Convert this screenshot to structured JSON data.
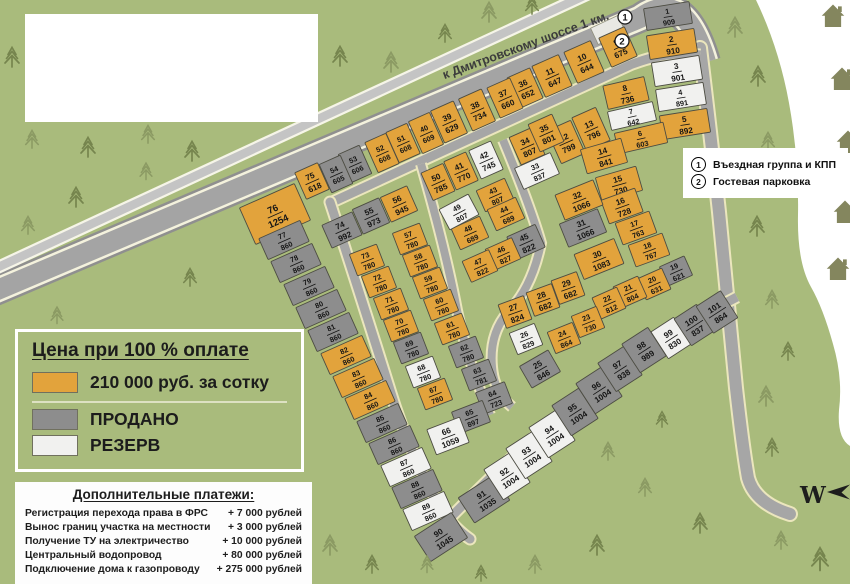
{
  "map": {
    "road_label": "к Дмитровскому шоссе 1 км.",
    "compass_letter": "W",
    "markers": [
      {
        "symbol": "1",
        "label": "Въездная группа и КПП"
      },
      {
        "symbol": "2",
        "label": "Гостевая парковка"
      }
    ]
  },
  "price_legend": {
    "title": "Цена при 100 % оплате",
    "available_label": "210 000 руб. за сотку",
    "sold_label": "ПРОДАНО",
    "reserve_label": "РЕЗЕРВ"
  },
  "extra_payments": {
    "title": "Дополнительные платежи:",
    "items": [
      {
        "label": "Регистрация перехода права в ФРС",
        "value": "+ 7 000 рублей"
      },
      {
        "label": "Вынос границ участка на местности",
        "value": "+ 3 000 рублей"
      },
      {
        "label": "Получение ТУ на электричество",
        "value": "+ 10 000 рублей"
      },
      {
        "label": "Центральный водопровод",
        "value": "+ 80 000 рублей"
      },
      {
        "label": "Подключение дома к газопроводу",
        "value": "+ 275 000 рублей"
      }
    ]
  },
  "colors": {
    "available": "#e2a33c",
    "sold": "#8d8d8d",
    "reserve": "#f1f1ef",
    "plot_stroke": "#4c4c42",
    "green": "#a9bb7c"
  },
  "plots": [
    {
      "n": 1,
      "area": 909,
      "status": "sold"
    },
    {
      "n": 2,
      "area": 910,
      "status": "available"
    },
    {
      "n": 3,
      "area": 901,
      "status": "reserve"
    },
    {
      "n": 4,
      "area": 891,
      "status": "reserve"
    },
    {
      "n": 5,
      "area": 892,
      "status": "available"
    },
    {
      "n": 6,
      "area": 603,
      "status": "available"
    },
    {
      "n": 7,
      "area": 642,
      "status": "reserve"
    },
    {
      "n": 8,
      "area": 736,
      "status": "available"
    },
    {
      "n": 9,
      "area": 675,
      "status": "available"
    },
    {
      "n": 10,
      "area": 644,
      "status": "available"
    },
    {
      "n": 11,
      "area": 647,
      "status": "available"
    },
    {
      "n": 12,
      "area": 799,
      "status": "available"
    },
    {
      "n": 13,
      "area": 796,
      "status": "available"
    },
    {
      "n": 14,
      "area": 841,
      "status": "available"
    },
    {
      "n": 15,
      "area": 730,
      "status": "available"
    },
    {
      "n": 16,
      "area": 728,
      "status": "available"
    },
    {
      "n": 17,
      "area": 763,
      "status": "available"
    },
    {
      "n": 18,
      "area": 767,
      "status": "available"
    },
    {
      "n": 19,
      "area": 621,
      "status": "sold"
    },
    {
      "n": 20,
      "area": 631,
      "status": "available"
    },
    {
      "n": 21,
      "area": 804,
      "status": "available"
    },
    {
      "n": 22,
      "area": 812,
      "status": "available"
    },
    {
      "n": 23,
      "area": 730,
      "status": "available"
    },
    {
      "n": 24,
      "area": 864,
      "status": "available"
    },
    {
      "n": 25,
      "area": 846,
      "status": "sold"
    },
    {
      "n": 26,
      "area": 829,
      "status": "reserve"
    },
    {
      "n": 27,
      "area": 824,
      "status": "available"
    },
    {
      "n": 28,
      "area": 682,
      "status": "available"
    },
    {
      "n": 29,
      "area": 682,
      "status": "available"
    },
    {
      "n": 30,
      "area": 1083,
      "status": "available"
    },
    {
      "n": 31,
      "area": 1066,
      "status": "sold"
    },
    {
      "n": 32,
      "area": 1066,
      "status": "available"
    },
    {
      "n": 33,
      "area": 837,
      "status": "reserve"
    },
    {
      "n": 34,
      "area": 807,
      "status": "available"
    },
    {
      "n": 35,
      "area": 801,
      "status": "available"
    },
    {
      "n": 36,
      "area": 652,
      "status": "available"
    },
    {
      "n": 37,
      "area": 660,
      "status": "available"
    },
    {
      "n": 38,
      "area": 734,
      "status": "available"
    },
    {
      "n": 39,
      "area": 629,
      "status": "available"
    },
    {
      "n": 40,
      "area": 609,
      "status": "available"
    },
    {
      "n": 41,
      "area": 770,
      "status": "available"
    },
    {
      "n": 42,
      "area": 745,
      "status": "reserve"
    },
    {
      "n": 43,
      "area": 807,
      "status": "available"
    },
    {
      "n": 44,
      "area": 689,
      "status": "available"
    },
    {
      "n": 45,
      "area": 822,
      "status": "sold"
    },
    {
      "n": 46,
      "area": 827,
      "status": "available"
    },
    {
      "n": 47,
      "area": 822,
      "status": "available"
    },
    {
      "n": 48,
      "area": 689,
      "status": "available"
    },
    {
      "n": 49,
      "area": 807,
      "status": "reserve"
    },
    {
      "n": 50,
      "area": 785,
      "status": "available"
    },
    {
      "n": 51,
      "area": 608,
      "status": "available"
    },
    {
      "n": 52,
      "area": 608,
      "status": "available"
    },
    {
      "n": 53,
      "area": 606,
      "status": "sold"
    },
    {
      "n": 54,
      "area": 605,
      "status": "sold"
    },
    {
      "n": 55,
      "area": 973,
      "status": "sold"
    },
    {
      "n": 56,
      "area": 945,
      "status": "available"
    },
    {
      "n": 57,
      "area": 780,
      "status": "available"
    },
    {
      "n": 58,
      "area": 780,
      "status": "available"
    },
    {
      "n": 59,
      "area": 780,
      "status": "available"
    },
    {
      "n": 60,
      "area": 780,
      "status": "available"
    },
    {
      "n": 61,
      "area": 780,
      "status": "available"
    },
    {
      "n": 62,
      "area": 780,
      "status": "sold"
    },
    {
      "n": 63,
      "area": 781,
      "status": "sold"
    },
    {
      "n": 64,
      "area": 723,
      "status": "sold"
    },
    {
      "n": 65,
      "area": 897,
      "status": "sold"
    },
    {
      "n": 66,
      "area": 1059,
      "status": "reserve"
    },
    {
      "n": 67,
      "area": 780,
      "status": "available"
    },
    {
      "n": 68,
      "area": 780,
      "status": "reserve"
    },
    {
      "n": 69,
      "area": 780,
      "status": "sold"
    },
    {
      "n": 70,
      "area": 780,
      "status": "available"
    },
    {
      "n": 71,
      "area": 780,
      "status": "available"
    },
    {
      "n": 72,
      "area": 780,
      "status": "available"
    },
    {
      "n": 73,
      "area": 780,
      "status": "available"
    },
    {
      "n": 74,
      "area": 992,
      "status": "sold"
    },
    {
      "n": 75,
      "area": 618,
      "status": "available"
    },
    {
      "n": 76,
      "area": 1254,
      "status": "available"
    },
    {
      "n": 77,
      "area": 860,
      "status": "sold"
    },
    {
      "n": 78,
      "area": 860,
      "status": "sold"
    },
    {
      "n": 79,
      "area": 860,
      "status": "sold"
    },
    {
      "n": 80,
      "area": 860,
      "status": "sold"
    },
    {
      "n": 81,
      "area": 860,
      "status": "sold"
    },
    {
      "n": 82,
      "area": 860,
      "status": "available"
    },
    {
      "n": 83,
      "area": 860,
      "status": "available"
    },
    {
      "n": 84,
      "area": 860,
      "status": "available"
    },
    {
      "n": 85,
      "area": 860,
      "status": "sold"
    },
    {
      "n": 86,
      "area": 860,
      "status": "sold"
    },
    {
      "n": 87,
      "area": 860,
      "status": "reserve"
    },
    {
      "n": 88,
      "area": 860,
      "status": "sold"
    },
    {
      "n": 89,
      "area": 860,
      "status": "reserve"
    },
    {
      "n": 90,
      "area": 1045,
      "status": "sold"
    },
    {
      "n": 91,
      "area": 1035,
      "status": "sold"
    },
    {
      "n": 92,
      "area": 1004,
      "status": "reserve"
    },
    {
      "n": 93,
      "area": 1004,
      "status": "reserve"
    },
    {
      "n": 94,
      "area": 1004,
      "status": "reserve"
    },
    {
      "n": 95,
      "area": 1004,
      "status": "sold"
    },
    {
      "n": 96,
      "area": 1004,
      "status": "sold"
    },
    {
      "n": 97,
      "area": 938,
      "status": "sold"
    },
    {
      "n": 98,
      "area": 989,
      "status": "sold"
    },
    {
      "n": 99,
      "area": 830,
      "status": "reserve"
    },
    {
      "n": 100,
      "area": 837,
      "status": "sold"
    },
    {
      "n": 101,
      "area": 864,
      "status": "sold"
    }
  ]
}
